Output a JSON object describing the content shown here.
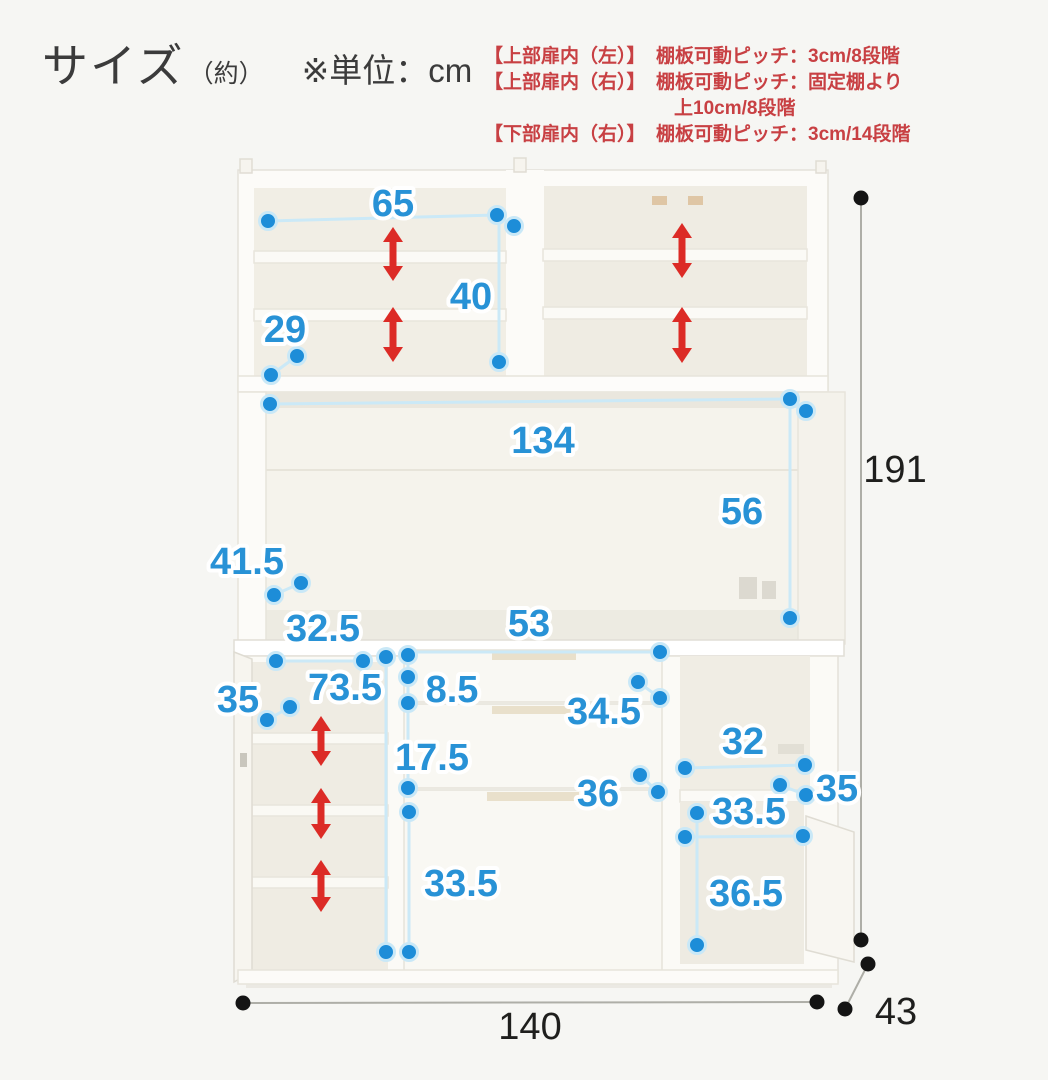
{
  "header": {
    "title": "サイズ",
    "title_suffix": "（約）",
    "unit_note": "※単位：cm",
    "note_color": "#c84043",
    "notes": [
      {
        "label": "【上部扉内（左）】",
        "text": "棚板可動ピッチ：3cm/8段階"
      },
      {
        "label": "【上部扉内（右）】",
        "text": "棚板可動ピッチ：固定棚より"
      },
      {
        "label": "",
        "text": "上10cm/8段階"
      },
      {
        "label": "【下部扉内（右）】",
        "text": "棚板可動ピッチ：3cm/14段階"
      }
    ]
  },
  "diagram": {
    "unit": "cm",
    "overall": {
      "width": "140",
      "height": "191",
      "depth": "43"
    },
    "colors": {
      "label_blue": "#2892d6",
      "label_black": "#1f1f1d",
      "dot_blue": "#1d8dd8",
      "dot_ring": "#c9e8f7",
      "line_blue": "#cbe9f7",
      "line_black": "#aeaea7",
      "arrow_red": "#dc2b26"
    },
    "labels": [
      {
        "t": "65",
        "x": 393,
        "y": 204,
        "c": "blue"
      },
      {
        "t": "40",
        "x": 471,
        "y": 297,
        "c": "blue"
      },
      {
        "t": "29",
        "x": 285,
        "y": 330,
        "c": "blue"
      },
      {
        "t": "134",
        "x": 543,
        "y": 441,
        "c": "blue"
      },
      {
        "t": "56",
        "x": 742,
        "y": 512,
        "c": "blue"
      },
      {
        "t": "41.5",
        "x": 247,
        "y": 562,
        "c": "blue"
      },
      {
        "t": "32.5",
        "x": 323,
        "y": 629,
        "c": "blue"
      },
      {
        "t": "73.5",
        "x": 345,
        "y": 688,
        "c": "blue"
      },
      {
        "t": "35",
        "x": 238,
        "y": 700,
        "c": "blue"
      },
      {
        "t": "8.5",
        "x": 452,
        "y": 690,
        "c": "blue"
      },
      {
        "t": "53",
        "x": 529,
        "y": 624,
        "c": "blue"
      },
      {
        "t": "34.5",
        "x": 604,
        "y": 712,
        "c": "blue"
      },
      {
        "t": "17.5",
        "x": 432,
        "y": 758,
        "c": "blue"
      },
      {
        "t": "36",
        "x": 598,
        "y": 794,
        "c": "blue"
      },
      {
        "t": "33.5",
        "x": 461,
        "y": 884,
        "c": "blue"
      },
      {
        "t": "32",
        "x": 743,
        "y": 742,
        "c": "blue"
      },
      {
        "t": "35",
        "x": 837,
        "y": 789,
        "c": "blue"
      },
      {
        "t": "33.5",
        "x": 749,
        "y": 812,
        "c": "blue"
      },
      {
        "t": "36.5",
        "x": 746,
        "y": 894,
        "c": "blue"
      },
      {
        "t": "191",
        "x": 895,
        "y": 470,
        "c": "black"
      },
      {
        "t": "140",
        "x": 530,
        "y": 1027,
        "c": "black"
      },
      {
        "t": "43",
        "x": 896,
        "y": 1012,
        "c": "black"
      }
    ],
    "lines": [
      {
        "x1": 268,
        "y1": 221,
        "x2": 497,
        "y2": 215,
        "c": "blue"
      },
      {
        "x1": 499,
        "y1": 217,
        "x2": 499,
        "y2": 362,
        "c": "blue"
      },
      {
        "x1": 297,
        "y1": 356,
        "x2": 271,
        "y2": 375,
        "c": "blue"
      },
      {
        "x1": 270,
        "y1": 404,
        "x2": 790,
        "y2": 399,
        "c": "blue"
      },
      {
        "x1": 790,
        "y1": 400,
        "x2": 790,
        "y2": 618,
        "c": "blue"
      },
      {
        "x1": 301,
        "y1": 583,
        "x2": 274,
        "y2": 595,
        "c": "blue"
      },
      {
        "x1": 276,
        "y1": 661,
        "x2": 363,
        "y2": 661,
        "c": "blue"
      },
      {
        "x1": 386,
        "y1": 657,
        "x2": 386,
        "y2": 952,
        "c": "blue"
      },
      {
        "x1": 290,
        "y1": 707,
        "x2": 267,
        "y2": 720,
        "c": "blue"
      },
      {
        "x1": 408,
        "y1": 655,
        "x2": 408,
        "y2": 703,
        "c": "blue"
      },
      {
        "x1": 410,
        "y1": 652,
        "x2": 660,
        "y2": 652,
        "c": "blue"
      },
      {
        "x1": 638,
        "y1": 682,
        "x2": 660,
        "y2": 698,
        "c": "blue"
      },
      {
        "x1": 408,
        "y1": 707,
        "x2": 408,
        "y2": 788,
        "c": "blue"
      },
      {
        "x1": 640,
        "y1": 775,
        "x2": 658,
        "y2": 792,
        "c": "blue"
      },
      {
        "x1": 409,
        "y1": 812,
        "x2": 409,
        "y2": 952,
        "c": "blue"
      },
      {
        "x1": 685,
        "y1": 768,
        "x2": 805,
        "y2": 765,
        "c": "blue"
      },
      {
        "x1": 780,
        "y1": 785,
        "x2": 806,
        "y2": 795,
        "c": "blue"
      },
      {
        "x1": 685,
        "y1": 837,
        "x2": 803,
        "y2": 836,
        "c": "blue"
      },
      {
        "x1": 697,
        "y1": 813,
        "x2": 697,
        "y2": 945,
        "c": "blue"
      },
      {
        "x1": 861,
        "y1": 198,
        "x2": 861,
        "y2": 940,
        "c": "black"
      },
      {
        "x1": 243,
        "y1": 1003,
        "x2": 817,
        "y2": 1002,
        "c": "black"
      },
      {
        "x1": 868,
        "y1": 964,
        "x2": 845,
        "y2": 1009,
        "c": "black"
      }
    ],
    "dots": [
      {
        "x": 268,
        "y": 221,
        "c": "blue"
      },
      {
        "x": 497,
        "y": 215,
        "c": "blue"
      },
      {
        "x": 514,
        "y": 226,
        "c": "blue"
      },
      {
        "x": 499,
        "y": 362,
        "c": "blue"
      },
      {
        "x": 297,
        "y": 356,
        "c": "blue"
      },
      {
        "x": 271,
        "y": 375,
        "c": "blue"
      },
      {
        "x": 270,
        "y": 404,
        "c": "blue"
      },
      {
        "x": 790,
        "y": 399,
        "c": "blue"
      },
      {
        "x": 806,
        "y": 411,
        "c": "blue"
      },
      {
        "x": 790,
        "y": 618,
        "c": "blue"
      },
      {
        "x": 301,
        "y": 583,
        "c": "blue"
      },
      {
        "x": 274,
        "y": 595,
        "c": "blue"
      },
      {
        "x": 276,
        "y": 661,
        "c": "blue"
      },
      {
        "x": 363,
        "y": 661,
        "c": "blue"
      },
      {
        "x": 386,
        "y": 657,
        "c": "blue"
      },
      {
        "x": 386,
        "y": 952,
        "c": "blue"
      },
      {
        "x": 290,
        "y": 707,
        "c": "blue"
      },
      {
        "x": 267,
        "y": 720,
        "c": "blue"
      },
      {
        "x": 408,
        "y": 655,
        "c": "blue"
      },
      {
        "x": 408,
        "y": 677,
        "c": "blue"
      },
      {
        "x": 408,
        "y": 703,
        "c": "blue"
      },
      {
        "x": 660,
        "y": 652,
        "c": "blue"
      },
      {
        "x": 638,
        "y": 682,
        "c": "blue"
      },
      {
        "x": 660,
        "y": 698,
        "c": "blue"
      },
      {
        "x": 408,
        "y": 788,
        "c": "blue"
      },
      {
        "x": 640,
        "y": 775,
        "c": "blue"
      },
      {
        "x": 658,
        "y": 792,
        "c": "blue"
      },
      {
        "x": 409,
        "y": 812,
        "c": "blue"
      },
      {
        "x": 409,
        "y": 952,
        "c": "blue"
      },
      {
        "x": 685,
        "y": 768,
        "c": "blue"
      },
      {
        "x": 805,
        "y": 765,
        "c": "blue"
      },
      {
        "x": 780,
        "y": 785,
        "c": "blue"
      },
      {
        "x": 806,
        "y": 795,
        "c": "blue"
      },
      {
        "x": 685,
        "y": 837,
        "c": "blue"
      },
      {
        "x": 803,
        "y": 836,
        "c": "blue"
      },
      {
        "x": 697,
        "y": 813,
        "c": "blue"
      },
      {
        "x": 697,
        "y": 945,
        "c": "blue"
      },
      {
        "x": 861,
        "y": 198,
        "c": "black"
      },
      {
        "x": 861,
        "y": 940,
        "c": "black"
      },
      {
        "x": 868,
        "y": 964,
        "c": "black"
      },
      {
        "x": 845,
        "y": 1009,
        "c": "black"
      },
      {
        "x": 243,
        "y": 1003,
        "c": "black"
      },
      {
        "x": 817,
        "y": 1002,
        "c": "black"
      }
    ],
    "arrows": [
      {
        "x": 393,
        "y1": 227,
        "y2": 281
      },
      {
        "x": 393,
        "y1": 307,
        "y2": 362
      },
      {
        "x": 682,
        "y1": 223,
        "y2": 278
      },
      {
        "x": 682,
        "y1": 307,
        "y2": 363
      },
      {
        "x": 321,
        "y1": 716,
        "y2": 766
      },
      {
        "x": 321,
        "y1": 788,
        "y2": 839
      },
      {
        "x": 321,
        "y1": 860,
        "y2": 912
      }
    ]
  }
}
